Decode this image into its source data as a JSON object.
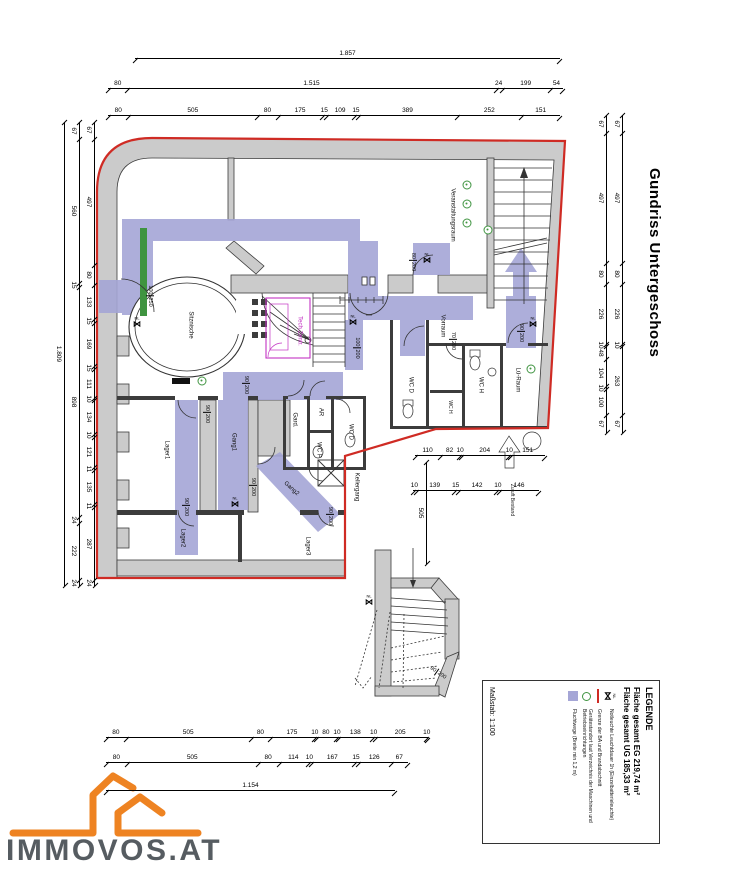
{
  "title": "Gundriss Untergeschoss",
  "logo": {
    "text": "IMMOVOS.AT"
  },
  "legend": {
    "heading": "LEGENDE",
    "area_eg": "Fläche gesamt EG 219,74 m²",
    "area_ug": "Fläche gesamt UG 185,33 m²",
    "nl_text": "NL",
    "items": [
      {
        "sym": "nl",
        "label": "Notleuchte Leuchtdauer 1h (Einzelbatterieleuchte)"
      },
      {
        "sym": "red",
        "label": "Grenze der BA und Brandabschnitt"
      },
      {
        "sym": "green",
        "label": "Gerätestandort laut Verzeichnis der Maschinen und Betriebseinrichtungen"
      },
      {
        "sym": "purple",
        "label": "Fluchtwege (Breite min 1,2 m)"
      }
    ],
    "scale": "Maßstab: 1:100"
  },
  "colors": {
    "walls": "#cbcbcb",
    "walledge": "#3c3c3c",
    "purple": "#a5a6d6",
    "green": "#3f9440",
    "red": "#cf2b24",
    "magenta": "#c233c2",
    "logoorange": "#ee8322",
    "logotext": "#565c61"
  },
  "dims": {
    "top": [
      [
        "1.857"
      ],
      [
        "80",
        "1.515",
        "24",
        "199",
        "54"
      ],
      [
        "80",
        "505",
        "80",
        "175",
        "15",
        "109",
        "15",
        "389",
        "252",
        "151"
      ]
    ],
    "bottom": [
      [
        "80",
        "505",
        "80",
        "175",
        "10",
        "80",
        "10",
        "138",
        "10",
        "205",
        "10"
      ],
      [
        "80",
        "505",
        "80",
        "114",
        "10",
        "167",
        "15",
        "126",
        "67"
      ],
      [
        "1.154"
      ]
    ],
    "left": [
      [
        "1.809"
      ],
      [
        "67",
        "560",
        "15",
        "898",
        "24",
        "222",
        "24"
      ],
      [
        "67",
        "497",
        "80",
        "133",
        "15",
        "169",
        "15",
        "111",
        "10",
        "134",
        "10",
        "121",
        "11",
        "135",
        "11",
        "287",
        "24"
      ]
    ],
    "right": [
      [
        "67",
        "497",
        "80",
        "226",
        "10",
        "48",
        "104",
        "10",
        "100",
        "67"
      ],
      [
        "67",
        "497",
        "80",
        "226",
        "10",
        "263",
        "67"
      ]
    ],
    "interior": [
      [
        "110",
        "82",
        "10",
        "204",
        "10",
        "151"
      ],
      [
        "10",
        "139",
        "15",
        "142",
        "10",
        "146"
      ],
      [
        "505"
      ]
    ]
  },
  "plan": {
    "nl_text": "NL",
    "bowtie": "⋈",
    "labels": [
      {
        "t": "Veranstaltungsraum",
        "x": 452,
        "y": 215
      },
      {
        "t": "Vorraum",
        "x": 442,
        "y": 326
      },
      {
        "t": "WC D",
        "x": 410,
        "y": 385
      },
      {
        "t": "WC H",
        "x": 480,
        "y": 385
      },
      {
        "t": "WC H",
        "x": 449,
        "y": 407,
        "c": "small"
      },
      {
        "t": "Lü-Raum",
        "x": 517,
        "y": 380
      },
      {
        "t": "Sitznische",
        "x": 190,
        "y": 325
      },
      {
        "t": "Tech.Zentr.",
        "x": 299,
        "y": 331,
        "c": "magenta"
      },
      {
        "t": "Gard.",
        "x": 294,
        "y": 420
      },
      {
        "t": "AR",
        "x": 320,
        "y": 412
      },
      {
        "t": "WC P",
        "x": 318,
        "y": 450
      },
      {
        "t": "WC D",
        "x": 350,
        "y": 432
      },
      {
        "t": "Gang1",
        "x": 233,
        "y": 442
      },
      {
        "t": "Lager1",
        "x": 166,
        "y": 450
      },
      {
        "t": "Gang2",
        "x": 291,
        "y": 489,
        "r": -48
      },
      {
        "t": "Lager2",
        "x": 182,
        "y": 538
      },
      {
        "t": "Lager3",
        "x": 307,
        "y": 546
      },
      {
        "t": "Kellergang",
        "x": 356,
        "y": 487
      },
      {
        "t": "Zuluft Bestand",
        "x": 511,
        "y": 500,
        "c": "small"
      }
    ],
    "door_dims": [
      {
        "a": "100",
        "b": "250",
        "x": 150,
        "y": 296
      },
      {
        "a": "80",
        "b": "200",
        "x": 413,
        "y": 262
      },
      {
        "a": "100",
        "b": "200",
        "x": 357,
        "y": 348
      },
      {
        "a": "70",
        "b": "200",
        "x": 453,
        "y": 341
      },
      {
        "a": "90",
        "b": "200",
        "x": 521,
        "y": 333
      },
      {
        "a": "90",
        "b": "200",
        "x": 246,
        "y": 385
      },
      {
        "a": "90",
        "b": "200",
        "x": 207,
        "y": 414
      },
      {
        "a": "90",
        "b": "200",
        "x": 186,
        "y": 507
      },
      {
        "a": "90",
        "b": "200",
        "x": 253,
        "y": 487
      },
      {
        "a": "90",
        "b": "200",
        "x": 330,
        "y": 516
      },
      {
        "a": "90",
        "b": "200",
        "x": 438,
        "y": 673,
        "r": -55
      }
    ],
    "nl_marks": [
      {
        "x": 137,
        "y": 322
      },
      {
        "x": 353,
        "y": 320
      },
      {
        "x": 427,
        "y": 258
      },
      {
        "x": 533,
        "y": 322
      },
      {
        "x": 369,
        "y": 600
      },
      {
        "x": 235,
        "y": 502
      }
    ],
    "green_marks": [
      {
        "x": 467,
        "y": 185
      },
      {
        "x": 467,
        "y": 204
      },
      {
        "x": 467,
        "y": 223
      },
      {
        "x": 488,
        "y": 230
      },
      {
        "x": 202,
        "y": 381
      },
      {
        "x": 531,
        "y": 369
      }
    ]
  }
}
